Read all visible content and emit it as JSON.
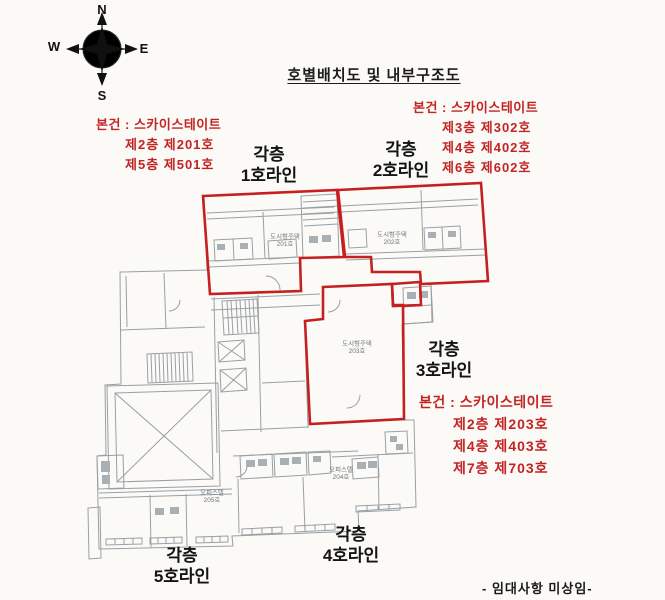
{
  "title": "호별배치도 및 내부구조도",
  "compass": {
    "n": "N",
    "e": "E",
    "s": "S",
    "w": "W"
  },
  "annotations": {
    "line1": {
      "header": "본건 : 스카이스테이트",
      "rows": [
        "제2층 제201호",
        "제5층 제501호"
      ]
    },
    "line2": {
      "header": "본건 : 스카이스테이트",
      "rows": [
        "제3층 제302호",
        "제4층 제402호",
        "제6층 제602호"
      ]
    },
    "line3": {
      "header": "본건 : 스카이스테이트",
      "rows": [
        "제2층 제203호",
        "제4층 제403호",
        "제7층 제703호"
      ]
    }
  },
  "line_labels": {
    "line1": [
      "각층",
      "1호라인"
    ],
    "line2": [
      "각층",
      "2호라인"
    ],
    "line3": [
      "각층",
      "3호라인"
    ],
    "line4": [
      "각층",
      "4호라인"
    ],
    "line5": [
      "각층",
      "5호라인"
    ]
  },
  "plan_units": {
    "u201": [
      "도시형주택",
      "201호"
    ],
    "u202": [
      "도시형주택",
      "202호"
    ],
    "u203": [
      "도시형주택",
      "203호"
    ],
    "u204": [
      "오피스텔",
      "204호"
    ],
    "u205": [
      "오피스텔",
      "205호"
    ]
  },
  "footer": "- 임대사항 미상임-",
  "colors": {
    "outline_red": "#c51f1f",
    "text_red": "#c22424",
    "plan_gray": "#98a0a5"
  }
}
